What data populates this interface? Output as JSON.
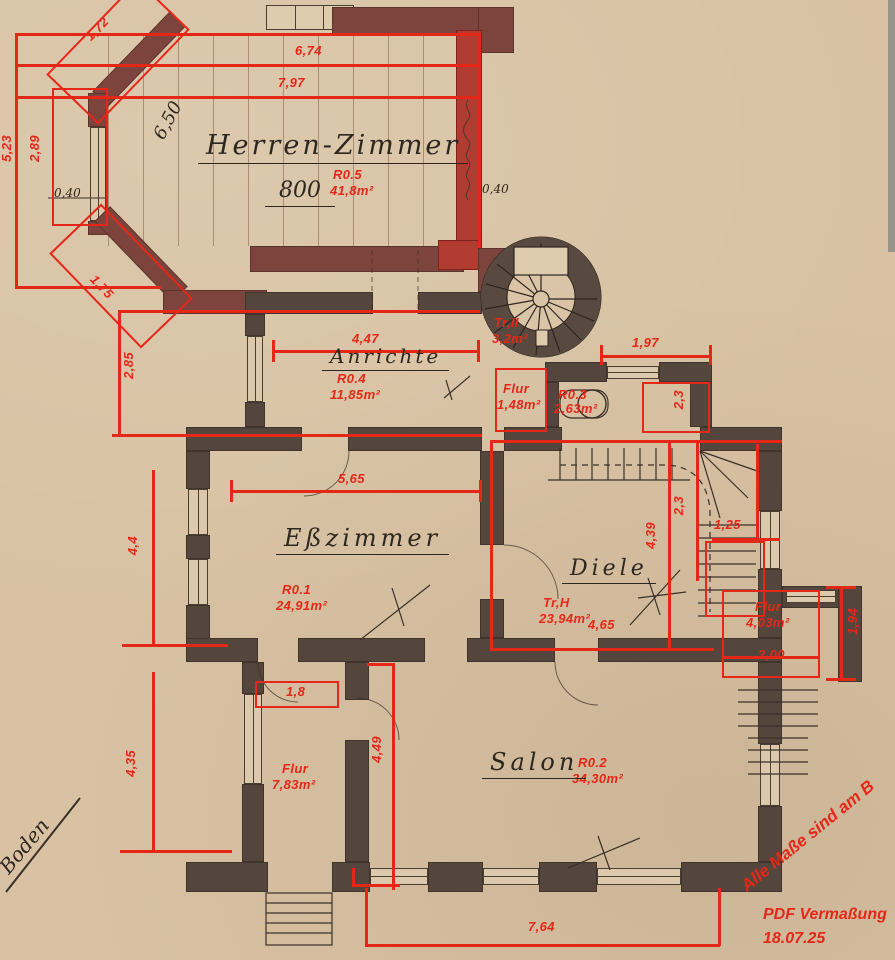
{
  "paper_color": "#d8c2a3",
  "accent_red": "#e52718",
  "wall_color": "#54463c",
  "highlight_wall_red": "#b23b32",
  "rooms": {
    "herrenzimmer": {
      "label": "Herren-Zimmer",
      "id": "R0.5",
      "area": "41,8m²",
      "hand": "800"
    },
    "anrichte": {
      "label": "Anrichte",
      "id": "R0.4",
      "area": "11,85m²"
    },
    "esszimmer": {
      "label": "Eßzimmer",
      "id": "R0.1",
      "area": "24,91m²"
    },
    "diele": {
      "label": "Diele",
      "id": "Tr,H",
      "area": "23,94m²"
    },
    "salon": {
      "label": "Salon",
      "id": "R0.2",
      "area": "34,30m²"
    },
    "tr2": {
      "id": "Tr,II",
      "area": "3,2m²"
    },
    "flur_klein": {
      "label": "Flur",
      "area": "1,48m²"
    },
    "wc": {
      "id": "R0.3",
      "area": "2,63m²"
    },
    "flur_eingang": {
      "label": "Flur",
      "area": "4,03m²"
    },
    "flur_west": {
      "label": "Flur",
      "area": "7,83m²"
    }
  },
  "dims": {
    "bay_diag_top": "1,72",
    "top_a": "6,74",
    "top_b": "7,97",
    "bay_v_outer": "5,23",
    "bay_v_inner": "2,89",
    "bay_diag_bottom": "1,75",
    "anrichte_v": "2,85",
    "anrichte_h": "4,47",
    "tower_h": "1,97",
    "wc_v": "2,3",
    "ess_h": "5,65",
    "ess_v": "4,4",
    "diele_h": "4,65",
    "diele_v": "4,39",
    "stair_v": "2,3",
    "stair_h": "1,25",
    "entry_h": "2,00",
    "entry_v": "1,94",
    "flur_h": "1,8",
    "flur_v": "4,35",
    "salon_v": "4,49",
    "salon_h": "7,64"
  },
  "hand_notes": {
    "board_len": "6,50",
    "off_left": "0,40",
    "off_right": "0,40",
    "margin_note": "Boden"
  },
  "stamp": {
    "rotated": "Alle Maße sind am B",
    "tool": "PDF Vermaßung",
    "date": "18.07.25"
  }
}
